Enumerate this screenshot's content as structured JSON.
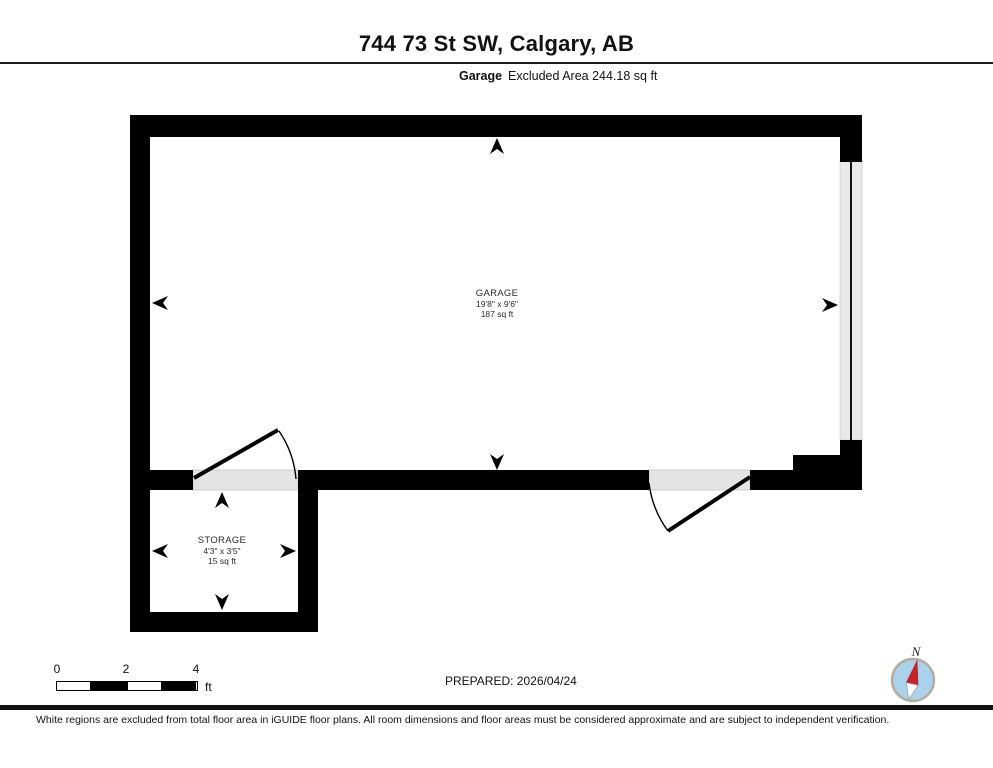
{
  "header": {
    "title": "744 73 St SW, Calgary, AB",
    "floor_label": "Garage",
    "excluded_area_label": "Excluded Area 244.18 sq ft"
  },
  "rooms": {
    "garage": {
      "name": "GARAGE",
      "dimensions": "19'8\" x 9'6\"",
      "area": "187 sq ft"
    },
    "storage": {
      "name": "STORAGE",
      "dimensions": "4'3\" x 3'5\"",
      "area": "15 sq ft"
    }
  },
  "scale_bar": {
    "ticks": [
      "0",
      "2",
      "4"
    ],
    "unit": "ft"
  },
  "prepared_label": "PREPARED: 2026/04/24",
  "compass": {
    "north_label": "N"
  },
  "disclaimer": "White regions are excluded from total floor area in iGUIDE floor plans. All room dimensions and floor areas must be considered approximate and are subject to independent verification.",
  "colors": {
    "wall": "#000000",
    "door_opening": "#e4e4e4",
    "garage_door_panel": "#e9e9e9",
    "compass_blue": "#a9d2ec",
    "compass_red": "#cf2026",
    "compass_ring": "#b5ac9c"
  }
}
